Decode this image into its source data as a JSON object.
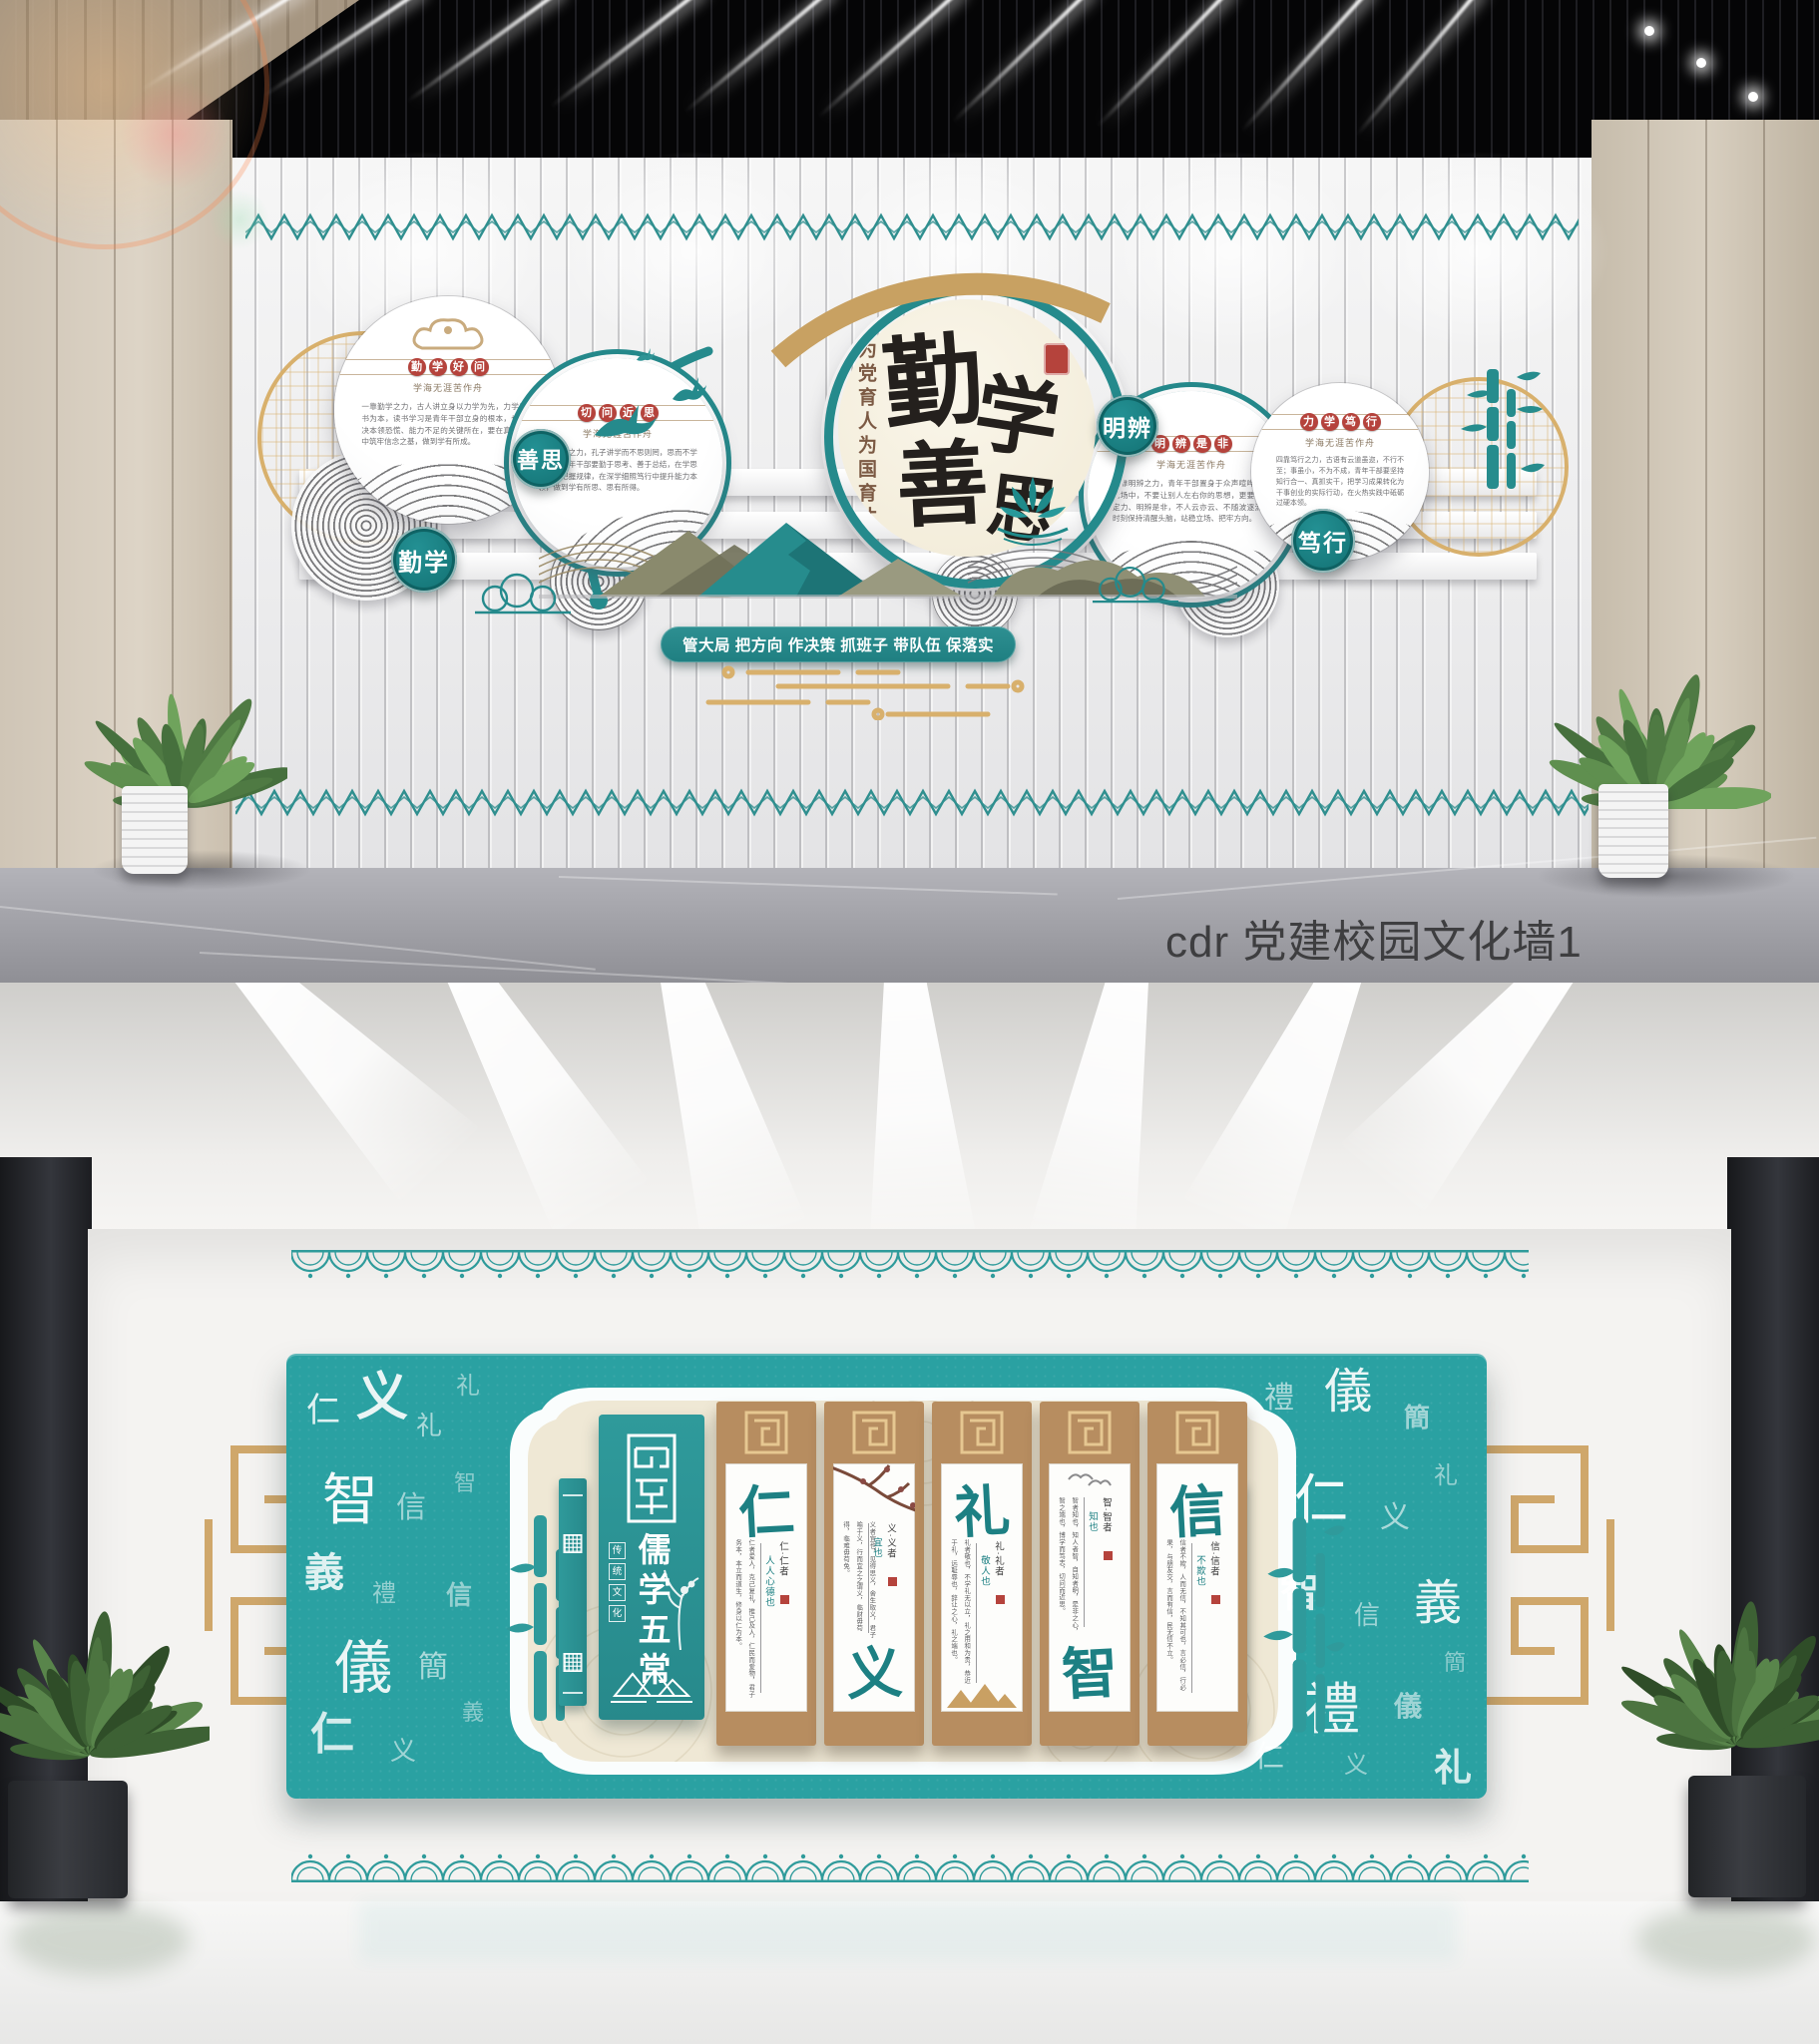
{
  "caption": {
    "text": "cdr 党建校园文化墙1"
  },
  "colors": {
    "teal": "#2a8f90",
    "teal_light": "#2aa1a2",
    "gold": "#d8b06c",
    "wood": "#b78d60",
    "seal_red": "#b5433c",
    "cream": "#f1ead6"
  },
  "wall1": {
    "center": {
      "chars": [
        "勤",
        "学",
        "善",
        "思"
      ],
      "slogan": "为党育人为国育才"
    },
    "badges": [
      {
        "label": "善思"
      },
      {
        "label": "勤学"
      },
      {
        "label": "明辨"
      },
      {
        "label": "笃行"
      }
    ],
    "panels": [
      {
        "title": "勤学好问",
        "subtitle": "学海无涯苦作舟",
        "body": "一靠勤学之力，古人讲立身以力学为先，力学以读书为本，读书学习是青年干部立身的根本，也是解决本领恐慌、能力不足的关键所在，要在真学真信中筑牢信念之基，做到学有所成。"
      },
      {
        "title": "切问近思",
        "subtitle": "学海无涯苦作舟",
        "body": "二靠善思之力，孔子讲学而不思则罔，思而不学则殆，青年干部要勤于思考、善于总结，在学思践悟中把握规律，在深学细照笃行中提升能力本领，做到学有所思、思有所得。"
      },
      {
        "title": "明辨是非",
        "subtitle": "学海无涯苦作舟",
        "body": "三靠明辨之力，青年干部置身于众声喧哗的舆论场中，不要让别人左右你的思想，更要保持定力、明辨是非，不人云亦云、不随波逐流，时刻保持清醒头脑，站稳立场、把牢方向。"
      },
      {
        "title": "力学笃行",
        "subtitle": "学海无涯苦作舟",
        "body": "四靠笃行之力，古语有云道虽迩，不行不至；事虽小，不为不成，青年干部要坚持知行合一、真抓实干，把学习成果转化为干事创业的实际行动，在火热实践中砥砺过硬本领。"
      }
    ],
    "banner": "管大局 把方向 作决策 抓班子 带队伍 保落实"
  },
  "wall2": {
    "title": "儒学五常",
    "subtitle": "传统文化",
    "panels": [
      {
        "char": "仁",
        "note": "仁·仁者",
        "note2": "人人心德也",
        "char_pos": "top",
        "body": "仁者爱人，克己复礼，推己及人，仁民而爱物，君子务本，本立而道生，修身以仁为本。"
      },
      {
        "char": "义",
        "note": "义·义者",
        "note2": "宜也",
        "char_pos": "bottom",
        "body": "义者宜也，见得思义，舍生取义，君子喻于义，行而宜之之谓义，临财毋苟得，临难毋苟免。"
      },
      {
        "char": "礼",
        "note": "礼·礼者",
        "note2": "敬人也",
        "char_pos": "top",
        "body": "礼者敬也，不学礼无以立，礼之用和为贵，恭近于礼，远耻辱也，辞让之心，礼之端也。"
      },
      {
        "char": "智",
        "note": "智·智者",
        "note2": "知也",
        "char_pos": "bottom",
        "body": "智者知也，知人者智，自知者明，是非之心，智之端也，博学而笃志，切问而近思。"
      },
      {
        "char": "信",
        "note": "信·信者",
        "note2": "不欺也",
        "char_pos": "top",
        "body": "信者不欺，人而无信，不知其可也，言必信，行必果，与朋友交，言而有信，民无信不立。"
      }
    ],
    "scatter_chars": [
      "仁",
      "义",
      "礼",
      "智",
      "信",
      "義",
      "禮",
      "儀",
      "簡"
    ]
  }
}
